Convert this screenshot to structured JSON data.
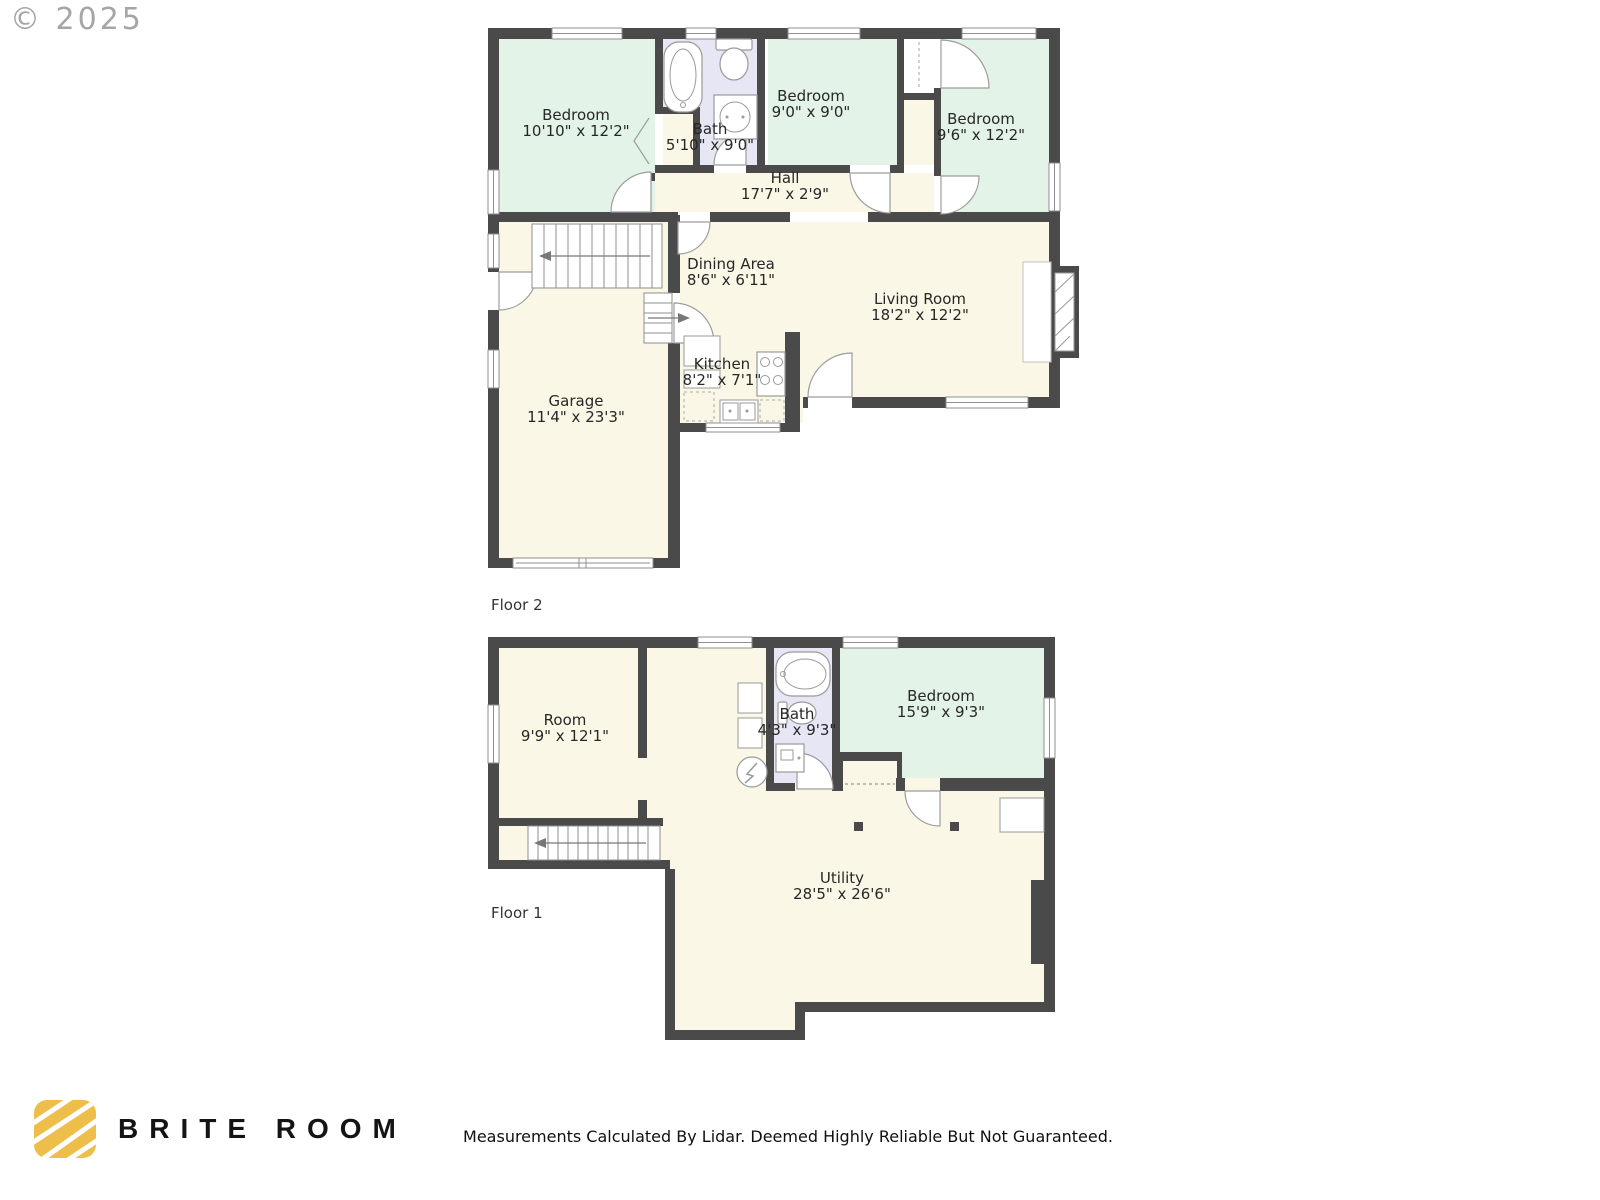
{
  "watermark": "© 2025",
  "disclaimer": "Measurements Calculated By Lidar. Deemed Highly Reliable But Not Guaranteed.",
  "brand": {
    "name": "BRITE ROOM",
    "logo_color": "#edbe4a"
  },
  "colors": {
    "wall": "#4a4a4a",
    "room_cream": "#faf7e6",
    "room_green": "#e4f3e8",
    "room_bath": "#e6e6f5",
    "fixture_line": "#9a9a9a"
  },
  "floor2": {
    "label": "Floor 2",
    "rooms": [
      {
        "name": "Bedroom",
        "dims": "10'10\" x 12'2\""
      },
      {
        "name": "Bath",
        "dims": "5'10\" x 9'0\""
      },
      {
        "name": "Bedroom",
        "dims": "9'0\" x 9'0\""
      },
      {
        "name": "Bedroom",
        "dims": "9'6\" x 12'2\""
      },
      {
        "name": "Hall",
        "dims": "17'7\" x 2'9\""
      },
      {
        "name": "Dining Area",
        "dims": "8'6\" x 6'11\""
      },
      {
        "name": "Living Room",
        "dims": "18'2\" x 12'2\""
      },
      {
        "name": "Kitchen",
        "dims": "8'2\" x 7'1\""
      },
      {
        "name": "Garage",
        "dims": "11'4\" x 23'3\""
      }
    ]
  },
  "floor1": {
    "label": "Floor 1",
    "rooms": [
      {
        "name": "Room",
        "dims": "9'9\" x 12'1\""
      },
      {
        "name": "Bath",
        "dims": "4'3\" x 9'3\""
      },
      {
        "name": "Bedroom",
        "dims": "15'9\" x 9'3\""
      },
      {
        "name": "Utility",
        "dims": "28'5\" x 26'6\""
      }
    ]
  }
}
